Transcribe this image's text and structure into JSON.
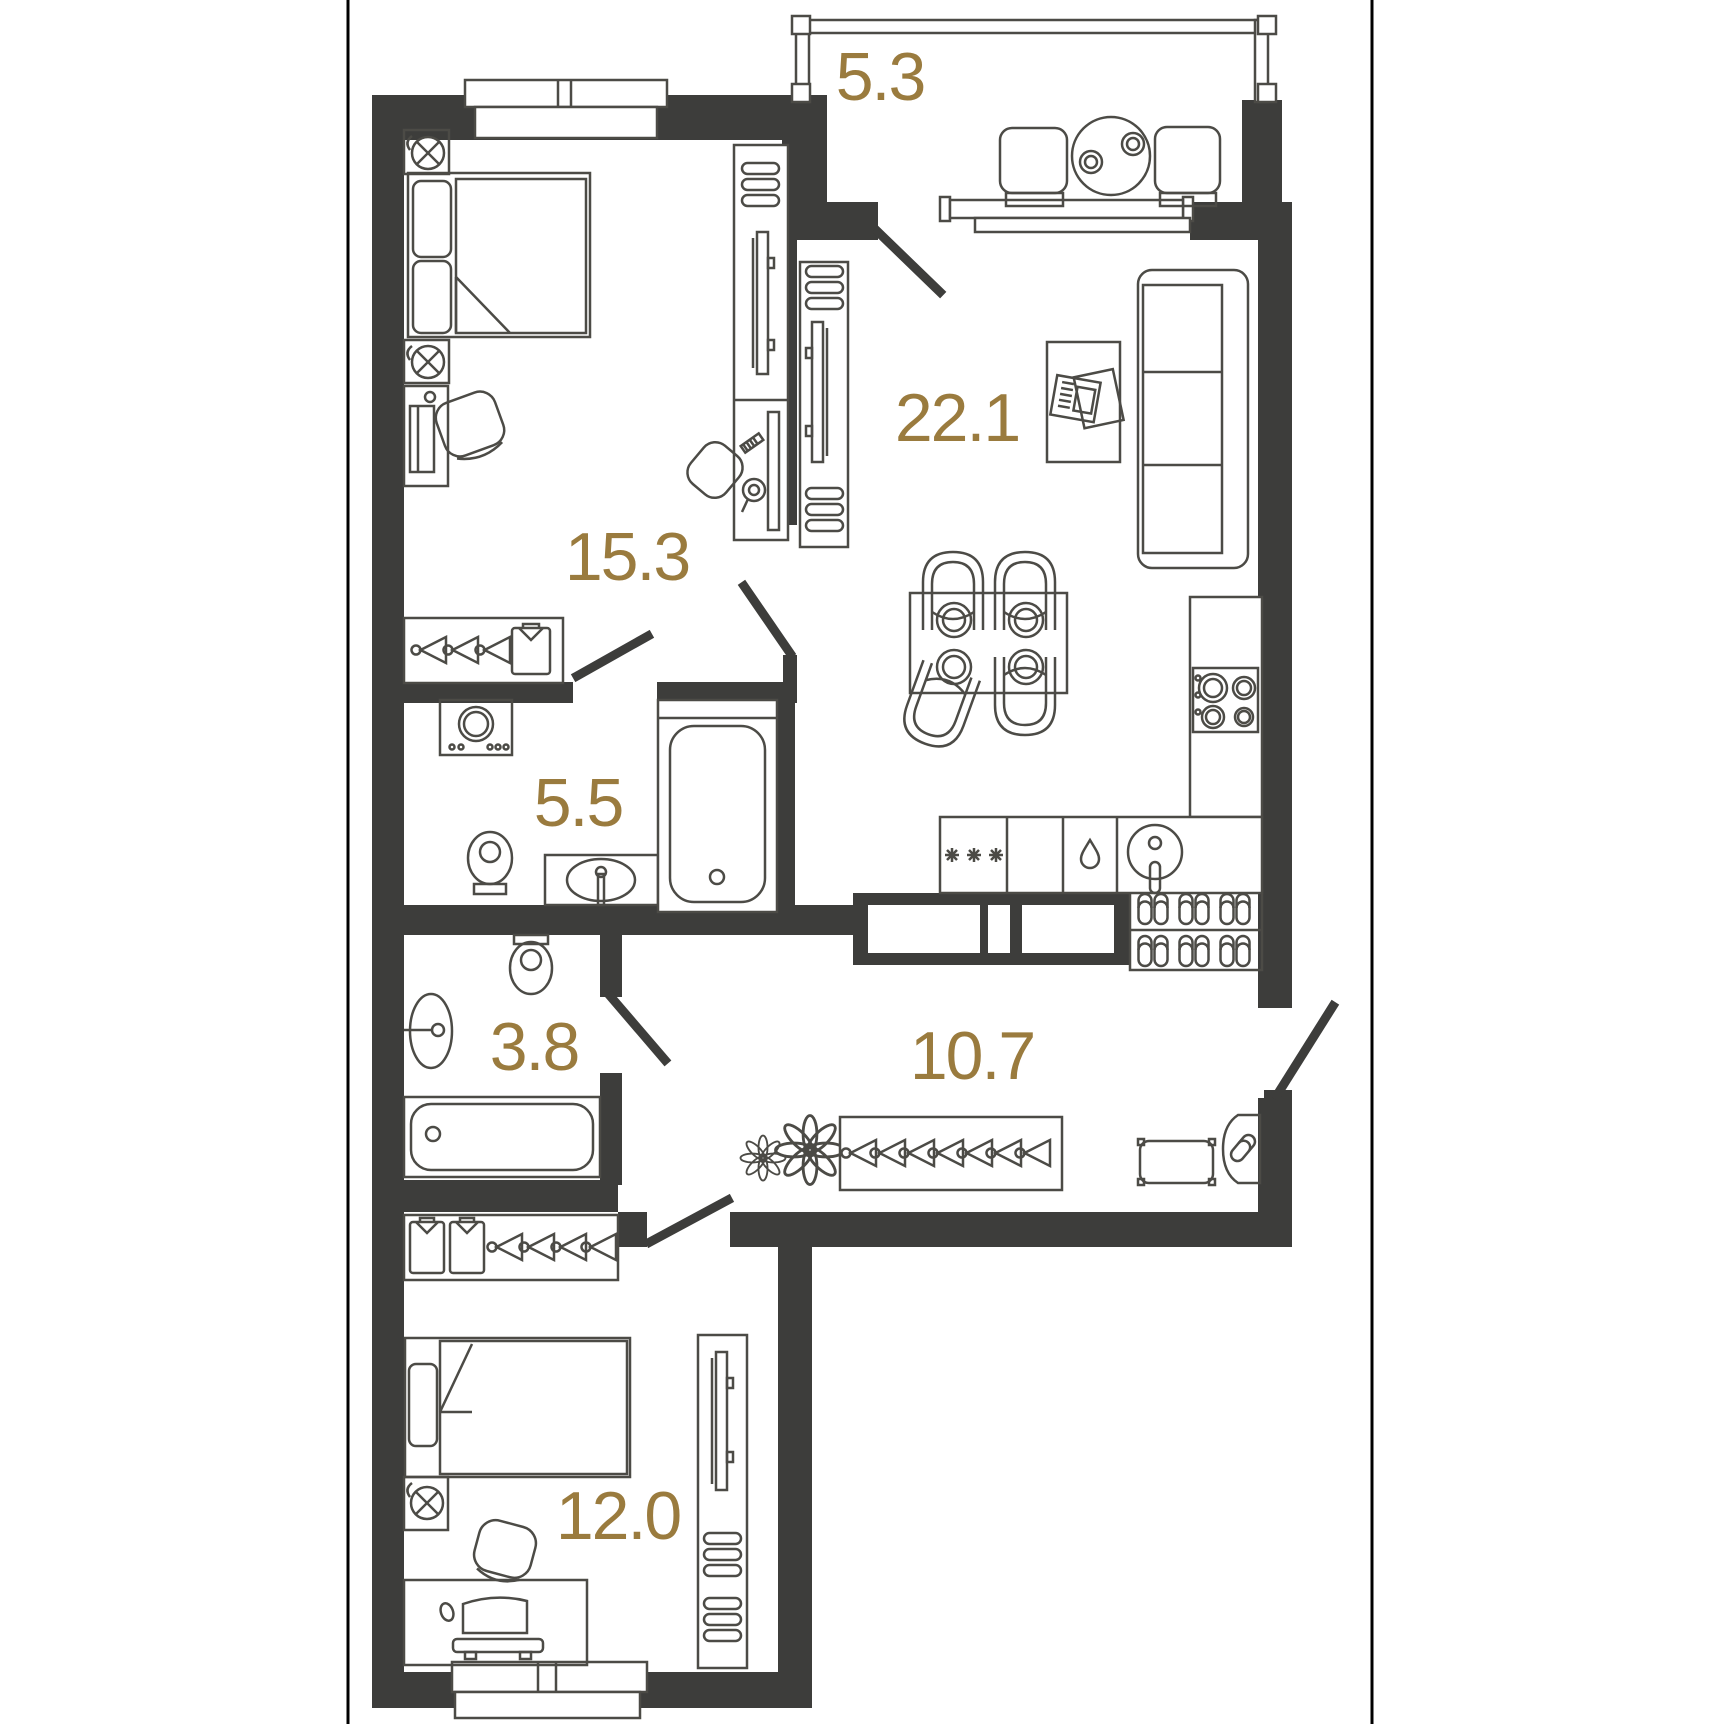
{
  "plan": {
    "type": "apartment-floor-plan",
    "colors": {
      "wall": "#3d3d3b",
      "furniture_line": "#4c4b46",
      "label": "#9a7b3e",
      "background": "#ffffff",
      "page_border": "#000000"
    },
    "rooms": [
      {
        "name": "loggia",
        "area": "5.3"
      },
      {
        "name": "bedroom",
        "area": "15.3"
      },
      {
        "name": "living-room-kitchen",
        "area": "22.1"
      },
      {
        "name": "bathroom",
        "area": "5.5"
      },
      {
        "name": "toilet",
        "area": "3.8"
      },
      {
        "name": "hallway",
        "area": "10.7"
      },
      {
        "name": "bedroom-2",
        "area": "12.0"
      }
    ]
  }
}
